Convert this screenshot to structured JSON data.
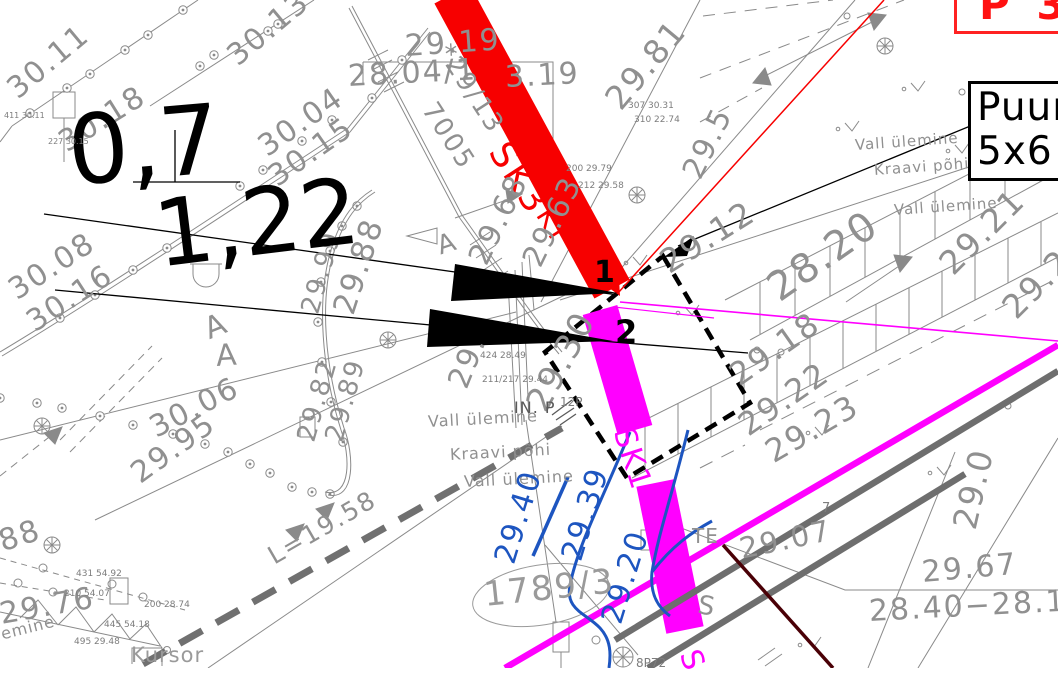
{
  "title": "Geodeetiline alusplaan — CAD vaade",
  "colors": {
    "g": "#909090",
    "k": "#000000",
    "b": "#1d55c0",
    "m": "#ff00ff",
    "r": "#f70000",
    "d": "#5a5a5a",
    "t": "#7d7d7d",
    "l": "#9a9a9a"
  },
  "info_box": {
    "line1": "Puur",
    "line2": "5x6 r"
  },
  "red_box": {
    "text": "P 33"
  },
  "labels": [
    {
      "n": "elevation-label",
      "t": "30.11",
      "x": 12,
      "y": 78,
      "s": 30,
      "r": -40,
      "c": "g"
    },
    {
      "n": "elevation-label",
      "t": "30.13",
      "x": 232,
      "y": 45,
      "s": 30,
      "r": -40,
      "c": "g"
    },
    {
      "n": "elevation-label",
      "t": "30.18",
      "x": 62,
      "y": 130,
      "s": 30,
      "r": -32,
      "c": "g"
    },
    {
      "n": "elevation-label",
      "t": "30.04",
      "x": 262,
      "y": 135,
      "s": 30,
      "r": -35,
      "c": "g"
    },
    {
      "n": "elevation-label",
      "t": "30.15",
      "x": 272,
      "y": 165,
      "s": 30,
      "r": -35,
      "c": "g"
    },
    {
      "n": "elevation-label",
      "t": "30.08",
      "x": 12,
      "y": 278,
      "s": 30,
      "r": -33,
      "c": "g"
    },
    {
      "n": "elevation-label",
      "t": "30.16",
      "x": 30,
      "y": 310,
      "s": 30,
      "r": -33,
      "c": "g"
    },
    {
      "n": "elevation-label",
      "t": "30.06",
      "x": 152,
      "y": 415,
      "s": 30,
      "r": -27,
      "c": "g"
    },
    {
      "n": "elevation-label",
      "t": "29.95",
      "x": 135,
      "y": 462,
      "s": 30,
      "r": -36,
      "c": "g"
    },
    {
      "n": "elevation-label",
      "t": "88",
      "x": 0,
      "y": 528,
      "s": 30,
      "r": -18,
      "c": "g"
    },
    {
      "n": "elevation-label",
      "t": "29.76",
      "x": 0,
      "y": 600,
      "s": 30,
      "r": -10,
      "c": "g"
    },
    {
      "n": "terrain-label",
      "t": "lemine",
      "x": -4,
      "y": 628,
      "s": 16,
      "r": -14,
      "c": "g",
      "ls": 1
    },
    {
      "n": "cursor-label",
      "t": "Kursor",
      "x": 131,
      "y": 645,
      "s": 21,
      "r": 0,
      "c": "l",
      "ls": 1
    },
    {
      "n": "length-label",
      "t": "L=19.58",
      "x": 270,
      "y": 545,
      "s": 25,
      "r": -30,
      "c": "g"
    },
    {
      "n": "elevation-label",
      "t": "29.99",
      "x": 310,
      "y": 300,
      "s": 26,
      "r": -74,
      "c": "g"
    },
    {
      "n": "elevation-label",
      "t": "29.88",
      "x": 344,
      "y": 298,
      "s": 31,
      "r": -72,
      "c": "g"
    },
    {
      "n": "elevation-label",
      "t": "29.82",
      "x": 306,
      "y": 428,
      "s": 26,
      "r": -74,
      "c": "g"
    },
    {
      "n": "elevation-label",
      "t": "29.89",
      "x": 334,
      "y": 428,
      "s": 26,
      "r": -74,
      "c": "g"
    },
    {
      "n": "dimension-value-big",
      "t": "0,7",
      "x": 68,
      "y": 104,
      "s": 96,
      "r": -5,
      "c": "k",
      "ls": 0
    },
    {
      "n": "dimension-value-big",
      "t": "1,22",
      "x": 155,
      "y": 190,
      "s": 92,
      "r": -7,
      "c": "k",
      "ls": 0
    },
    {
      "n": "point-number",
      "t": "1",
      "x": 594,
      "y": 258,
      "s": 30,
      "r": 0,
      "c": "k",
      "w": 700,
      "ls": 0
    },
    {
      "n": "point-number",
      "t": "2",
      "x": 615,
      "y": 316,
      "s": 32,
      "r": 0,
      "c": "k",
      "w": 700,
      "ls": 0
    },
    {
      "n": "elevation-label",
      "t": "29.19",
      "x": 405,
      "y": 32,
      "s": 30,
      "r": -4,
      "c": "g"
    },
    {
      "n": "elevation-label",
      "t": "28.04/1",
      "x": 348,
      "y": 62,
      "s": 30,
      "r": -3,
      "c": "g"
    },
    {
      "n": "elevation-label",
      "t": "3.19",
      "x": 505,
      "y": 63,
      "s": 30,
      "r": -3,
      "c": "g"
    },
    {
      "n": "survey-code",
      "t": "*29/13",
      "x": 443,
      "y": 34,
      "s": 26,
      "r": 57,
      "c": "g"
    },
    {
      "n": "survey-code",
      "t": "7005",
      "x": 428,
      "y": 92,
      "s": 26,
      "r": 57,
      "c": "g"
    },
    {
      "n": "borehole-label-sk3",
      "t": "SK3",
      "x": 497,
      "y": 128,
      "s": 36,
      "r": 57,
      "c": "r",
      "ls": 3
    },
    {
      "n": "borehole-label-kt",
      "t": "KT",
      "x": 543,
      "y": 196,
      "s": 28,
      "r": 58,
      "c": "r",
      "ls": 2
    },
    {
      "n": "elevation-label",
      "t": "29.81",
      "x": 612,
      "y": 88,
      "s": 33,
      "r": -50,
      "c": "g"
    },
    {
      "n": "elevation-label",
      "t": "29.5",
      "x": 692,
      "y": 162,
      "s": 30,
      "r": -64,
      "c": "g"
    },
    {
      "n": "terrain-label",
      "t": "Vall ülemine",
      "x": 855,
      "y": 138,
      "s": 15,
      "r": -4,
      "c": "g",
      "ls": 1
    },
    {
      "n": "terrain-label",
      "t": "Kraavi põhi",
      "x": 874,
      "y": 163,
      "s": 15,
      "r": -4,
      "c": "g",
      "ls": 1
    },
    {
      "n": "terrain-label",
      "t": "Vall ülemine",
      "x": 894,
      "y": 203,
      "s": 15,
      "r": -4,
      "c": "g",
      "ls": 1
    },
    {
      "n": "elevation-label",
      "t": "29.21",
      "x": 945,
      "y": 252,
      "s": 33,
      "r": -45,
      "c": "g"
    },
    {
      "n": "elevation-label",
      "t": "29.2",
      "x": 1008,
      "y": 296,
      "s": 33,
      "r": -45,
      "c": "g"
    },
    {
      "n": "elevation-label",
      "t": "29.12",
      "x": 663,
      "y": 248,
      "s": 33,
      "r": -32,
      "c": "g"
    },
    {
      "n": "elevation-label",
      "t": "28.20",
      "x": 772,
      "y": 272,
      "s": 40,
      "r": -35,
      "c": "g"
    },
    {
      "n": "elevation-label",
      "t": "29.18",
      "x": 733,
      "y": 362,
      "s": 32,
      "r": -35,
      "c": "g"
    },
    {
      "n": "elevation-label",
      "t": "29.22",
      "x": 742,
      "y": 412,
      "s": 32,
      "r": -35,
      "c": "g"
    },
    {
      "n": "elevation-label",
      "t": "29.23",
      "x": 768,
      "y": 438,
      "s": 32,
      "r": -30,
      "c": "g"
    },
    {
      "n": "elevation-label",
      "t": "29.0",
      "x": 964,
      "y": 512,
      "s": 33,
      "r": -77,
      "c": "g"
    },
    {
      "n": "elevation-label",
      "t": "29.67",
      "x": 922,
      "y": 558,
      "s": 30,
      "r": -5,
      "c": "g"
    },
    {
      "n": "elevation-range-label",
      "t": "28.40−28.13",
      "x": 869,
      "y": 597,
      "s": 30,
      "r": -3,
      "c": "g"
    },
    {
      "n": "elevation-label",
      "t": "29.07",
      "x": 740,
      "y": 535,
      "s": 29,
      "r": -12,
      "c": "g"
    },
    {
      "n": "elevation-label",
      "t": "29.30",
      "x": 536,
      "y": 392,
      "s": 34,
      "r": -62,
      "c": "g"
    },
    {
      "n": "elevation-label",
      "t": "29.68",
      "x": 478,
      "y": 248,
      "s": 30,
      "r": -64,
      "c": "g"
    },
    {
      "n": "elevation-label",
      "t": "29.63",
      "x": 532,
      "y": 250,
      "s": 30,
      "r": -64,
      "c": "g"
    },
    {
      "n": "terrain-label",
      "t": "Vall ülemine",
      "x": 428,
      "y": 414,
      "s": 16,
      "r": -3,
      "c": "g",
      "ls": 1
    },
    {
      "n": "terrain-label",
      "t": "Kraavi põhi",
      "x": 450,
      "y": 447,
      "s": 16,
      "r": -3,
      "c": "g",
      "ls": 1
    },
    {
      "n": "terrain-label",
      "t": "Vall ülemine",
      "x": 464,
      "y": 474,
      "s": 16,
      "r": -3,
      "c": "g",
      "ls": 1
    },
    {
      "n": "contour-label-blue",
      "t": "29.40",
      "x": 505,
      "y": 548,
      "s": 30,
      "r": -73,
      "c": "b",
      "ls": 2
    },
    {
      "n": "contour-label-blue",
      "t": "29.39",
      "x": 572,
      "y": 545,
      "s": 30,
      "r": -73,
      "c": "b",
      "ls": 2
    },
    {
      "n": "contour-label-blue",
      "t": "29.20",
      "x": 612,
      "y": 608,
      "s": 30,
      "r": -73,
      "c": "b",
      "ls": 2
    },
    {
      "n": "parcel-number",
      "t": "1789/3",
      "x": 484,
      "y": 578,
      "s": 34,
      "r": -6,
      "c": "l"
    },
    {
      "n": "utility-label",
      "t": "8P72",
      "x": 636,
      "y": 657,
      "s": 12,
      "r": 0,
      "c": "t",
      "ls": 0
    },
    {
      "n": "utility-label",
      "t": "12P",
      "x": 560,
      "y": 396,
      "s": 12,
      "r": 0,
      "c": "t",
      "ls": 0
    },
    {
      "n": "utility-label",
      "t": "IN. P",
      "x": 514,
      "y": 400,
      "s": 16,
      "r": 0,
      "c": "d",
      "ls": 1
    },
    {
      "n": "borehole-label-sk",
      "t": "S",
      "x": 688,
      "y": 636,
      "s": 30,
      "r": 70,
      "c": "m",
      "ls": 2
    },
    {
      "n": "borehole-label-sk1",
      "t": "SK1",
      "x": 622,
      "y": 414,
      "s": 30,
      "r": 72,
      "c": "m",
      "ls": 2
    },
    {
      "n": "terrain-label",
      "t": "TE",
      "x": 692,
      "y": 526,
      "s": 20,
      "r": 0,
      "c": "g",
      "ls": 1
    },
    {
      "n": "terrain-label",
      "t": "S",
      "x": 698,
      "y": 592,
      "s": 26,
      "r": 10,
      "c": "g"
    },
    {
      "n": "terrain-label",
      "t": "7",
      "x": 822,
      "y": 502,
      "s": 13,
      "r": 0,
      "c": "t",
      "ls": 0
    },
    {
      "n": "symbol-letter",
      "t": "A",
      "x": 206,
      "y": 316,
      "s": 30,
      "r": -22,
      "c": "g"
    },
    {
      "n": "symbol-letter",
      "t": "A",
      "x": 216,
      "y": 342,
      "s": 30,
      "r": -4,
      "c": "g"
    },
    {
      "n": "symbol-letter",
      "t": "A",
      "x": 438,
      "y": 234,
      "s": 26,
      "r": -18,
      "c": "g"
    },
    {
      "n": "elevation-label",
      "t": "29.",
      "x": 458,
      "y": 372,
      "s": 30,
      "r": -68,
      "c": "g"
    },
    {
      "n": "point-detail",
      "t": "424  28.49",
      "x": 480,
      "y": 352,
      "s": 9,
      "r": 0,
      "c": "t",
      "ls": 0
    },
    {
      "n": "point-detail",
      "t": "211/217  29.44",
      "x": 482,
      "y": 376,
      "s": 9,
      "r": 0,
      "c": "t",
      "ls": 0
    },
    {
      "n": "point-detail",
      "t": "200  29.79",
      "x": 566,
      "y": 165,
      "s": 9,
      "r": 0,
      "c": "t",
      "ls": 0
    },
    {
      "n": "point-detail",
      "t": "212  29.58",
      "x": 578,
      "y": 182,
      "s": 9,
      "r": 0,
      "c": "t",
      "ls": 0
    },
    {
      "n": "point-detail",
      "t": "307  30.31",
      "x": 628,
      "y": 102,
      "s": 9,
      "r": 0,
      "c": "t",
      "ls": 0
    },
    {
      "n": "point-detail",
      "t": "310  22.74",
      "x": 634,
      "y": 116,
      "s": 9,
      "r": 0,
      "c": "t",
      "ls": 0
    },
    {
      "n": "point-detail",
      "t": "210  54.07",
      "x": 64,
      "y": 590,
      "s": 9,
      "r": 0,
      "c": "t",
      "ls": 0
    },
    {
      "n": "point-detail",
      "t": "431  54.92",
      "x": 76,
      "y": 570,
      "s": 9,
      "r": 0,
      "c": "t",
      "ls": 0
    },
    {
      "n": "point-detail",
      "t": "445  54.18",
      "x": 104,
      "y": 621,
      "s": 9,
      "r": 0,
      "c": "t",
      "ls": 0
    },
    {
      "n": "point-detail",
      "t": "495  29.48",
      "x": 74,
      "y": 638,
      "s": 9,
      "r": 0,
      "c": "t",
      "ls": 0
    },
    {
      "n": "point-detail",
      "t": "200  28.74",
      "x": 144,
      "y": 601,
      "s": 9,
      "r": 0,
      "c": "t",
      "ls": 0
    },
    {
      "n": "point-detail",
      "t": "411  30.11",
      "x": 4,
      "y": 112,
      "s": 8,
      "r": 0,
      "c": "t",
      "ls": 0
    },
    {
      "n": "point-detail",
      "t": "227  30.15",
      "x": 48,
      "y": 138,
      "s": 8,
      "r": 0,
      "c": "t",
      "ls": 0
    }
  ]
}
